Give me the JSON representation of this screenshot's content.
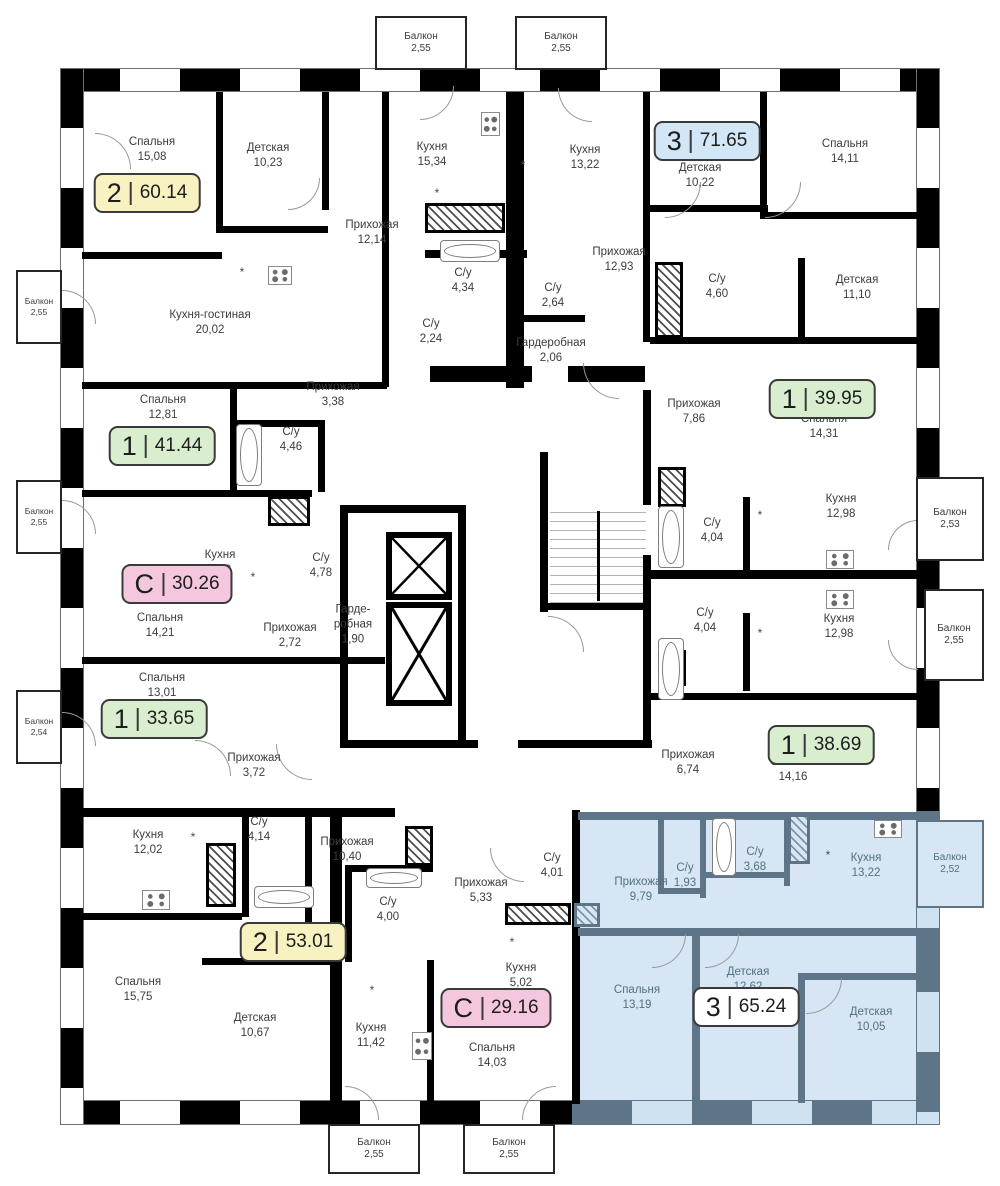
{
  "colors": {
    "wall": "#000000",
    "selected_fill": "#D6E6F4",
    "selected_wall": "#5E7487",
    "label_text": "#3c3c3c",
    "badge_yellow": "#F7F2C0",
    "badge_green": "#D9EECE",
    "badge_blue": "#D3E6F5",
    "badge_pink": "#F4C7DE",
    "badge_white": "#FFFFFF"
  },
  "balcony_label": "Балкон",
  "asterisk_glyph": "*",
  "badges": [
    {
      "num": "2",
      "area": "60.14",
      "color": "yellow",
      "x": 147,
      "y": 193
    },
    {
      "num": "3",
      "area": "71.65",
      "color": "blue",
      "x": 707,
      "y": 141
    },
    {
      "num": "1",
      "area": "41.44",
      "color": "green",
      "x": 162,
      "y": 446
    },
    {
      "num": "1",
      "area": "39.95",
      "color": "green",
      "x": 822,
      "y": 399
    },
    {
      "num": "С",
      "area": "30.26",
      "color": "pink",
      "x": 177,
      "y": 584
    },
    {
      "num": "1",
      "area": "33.65",
      "color": "green",
      "x": 154,
      "y": 719
    },
    {
      "num": "1",
      "area": "38.69",
      "color": "green",
      "x": 821,
      "y": 745
    },
    {
      "num": "2",
      "area": "53.01",
      "color": "yellow",
      "x": 293,
      "y": 942
    },
    {
      "num": "С",
      "area": "29.16",
      "color": "pink",
      "x": 496,
      "y": 1008
    },
    {
      "num": "3",
      "area": "65.24",
      "color": "white",
      "x": 746,
      "y": 1007,
      "selected": true
    }
  ],
  "rooms": [
    {
      "name": "Спальня",
      "area": "15,08",
      "x": 152,
      "y": 150
    },
    {
      "name": "Детская",
      "area": "10,23",
      "x": 268,
      "y": 156
    },
    {
      "name": "Кухня",
      "area": "15,34",
      "x": 432,
      "y": 155
    },
    {
      "name": "Кухня",
      "area": "13,22",
      "x": 585,
      "y": 158
    },
    {
      "name": "Детская",
      "area": "10,22",
      "x": 700,
      "y": 176
    },
    {
      "name": "Спальня",
      "area": "14,11",
      "x": 845,
      "y": 152
    },
    {
      "name": "Прихожая",
      "area": "12,14",
      "x": 372,
      "y": 233
    },
    {
      "name": "С/у",
      "area": "4,34",
      "x": 463,
      "y": 281
    },
    {
      "name": "С/у",
      "area": "2,64",
      "x": 553,
      "y": 296
    },
    {
      "name": "Прихожая",
      "area": "12,93",
      "x": 619,
      "y": 260
    },
    {
      "name": "С/у",
      "area": "4,60",
      "x": 717,
      "y": 287
    },
    {
      "name": "Детская",
      "area": "11,10",
      "x": 857,
      "y": 288
    },
    {
      "name": "Кухня-гостиная",
      "area": "20,02",
      "x": 210,
      "y": 323
    },
    {
      "name": "С/у",
      "area": "2,24",
      "x": 431,
      "y": 332
    },
    {
      "name": "Гардеробная",
      "area": "2,06",
      "x": 551,
      "y": 351
    },
    {
      "name": "Прихожая",
      "area": "3,38",
      "x": 333,
      "y": 395
    },
    {
      "name": "Спальня",
      "area": "12,81",
      "x": 163,
      "y": 408
    },
    {
      "name": "С/у",
      "area": "4,46",
      "x": 291,
      "y": 440
    },
    {
      "name": "Прихожая",
      "area": "7,86",
      "x": 694,
      "y": 412
    },
    {
      "name": "Спальня",
      "area": "14,31",
      "x": 824,
      "y": 427
    },
    {
      "name": "Кухня",
      "area": "5,88",
      "x": 220,
      "y": 563
    },
    {
      "name": "С/у",
      "area": "4,78",
      "x": 321,
      "y": 566
    },
    {
      "name": "Кухня",
      "area": "12,98",
      "x": 841,
      "y": 507
    },
    {
      "name": "С/у",
      "area": "4,04",
      "x": 712,
      "y": 531
    },
    {
      "name": "Спальня",
      "area": "14,21",
      "x": 160,
      "y": 626
    },
    {
      "name": "Прихожая",
      "area": "2,72",
      "x": 290,
      "y": 636
    },
    {
      "name": "Гарде- робная",
      "area": "1,90",
      "x": 353,
      "y": 625,
      "narrow": true
    },
    {
      "name": "С/у",
      "area": "4,04",
      "x": 705,
      "y": 621
    },
    {
      "name": "Кухня",
      "area": "12,98",
      "x": 839,
      "y": 627
    },
    {
      "name": "Спальня",
      "area": "13,01",
      "x": 162,
      "y": 686
    },
    {
      "name": "Прихожая",
      "area": "3,72",
      "x": 254,
      "y": 766
    },
    {
      "name": "Прихожая",
      "area": "6,74",
      "x": 688,
      "y": 763
    },
    {
      "name": "Спальня",
      "area": "14,16",
      "x": 793,
      "y": 770
    },
    {
      "name": "Кухня",
      "area": "12,02",
      "x": 148,
      "y": 843
    },
    {
      "name": "С/у",
      "area": "4,14",
      "x": 259,
      "y": 830
    },
    {
      "name": "Прихожая",
      "area": "10,40",
      "x": 347,
      "y": 850
    },
    {
      "name": "С/у",
      "area": "4,00",
      "x": 388,
      "y": 910
    },
    {
      "name": "Прихожая",
      "area": "5,33",
      "x": 481,
      "y": 891
    },
    {
      "name": "С/у",
      "area": "4,01",
      "x": 552,
      "y": 866
    },
    {
      "name": "Кухня",
      "area": "5,02",
      "x": 521,
      "y": 976
    },
    {
      "name": "Спальня",
      "area": "15,75",
      "x": 138,
      "y": 990
    },
    {
      "name": "Детская",
      "area": "10,67",
      "x": 255,
      "y": 1026
    },
    {
      "name": "Кухня",
      "area": "11,42",
      "x": 371,
      "y": 1036
    },
    {
      "name": "Спальня",
      "area": "14,03",
      "x": 492,
      "y": 1056
    },
    {
      "name": "Прихожая",
      "area": "9,79",
      "x": 641,
      "y": 890,
      "blue": true
    },
    {
      "name": "С/у",
      "area": "1,93",
      "x": 685,
      "y": 876,
      "blue": true
    },
    {
      "name": "С/у",
      "area": "3,68",
      "x": 755,
      "y": 860,
      "blue": true
    },
    {
      "name": "Кухня",
      "area": "13,22",
      "x": 866,
      "y": 866,
      "blue": true
    },
    {
      "name": "Спальня",
      "area": "13,19",
      "x": 637,
      "y": 998,
      "blue": true
    },
    {
      "name": "Детская",
      "area": "12,62",
      "x": 748,
      "y": 980,
      "blue": true
    },
    {
      "name": "Детская",
      "area": "10,05",
      "x": 871,
      "y": 1020,
      "blue": true
    }
  ],
  "balconies": [
    {
      "area": "2,55",
      "x": 375,
      "y": 16,
      "w": 92,
      "h": 54
    },
    {
      "area": "2,55",
      "x": 515,
      "y": 16,
      "w": 92,
      "h": 54
    },
    {
      "area": "2,55",
      "x": 16,
      "y": 270,
      "w": 46,
      "h": 74,
      "small": true
    },
    {
      "area": "2,55",
      "x": 16,
      "y": 480,
      "w": 46,
      "h": 74,
      "small": true
    },
    {
      "area": "2,54",
      "x": 16,
      "y": 690,
      "w": 46,
      "h": 74,
      "small": true
    },
    {
      "area": "2,53",
      "x": 916,
      "y": 477,
      "w": 68,
      "h": 84
    },
    {
      "area": "2,55",
      "x": 924,
      "y": 589,
      "w": 60,
      "h": 92
    },
    {
      "area": "2,52",
      "x": 916,
      "y": 820,
      "w": 68,
      "h": 88,
      "blue": true
    },
    {
      "area": "2,55",
      "x": 328,
      "y": 1124,
      "w": 92,
      "h": 50
    },
    {
      "area": "2,55",
      "x": 463,
      "y": 1124,
      "w": 92,
      "h": 50
    }
  ],
  "asterisks": [
    {
      "x": 242,
      "y": 272
    },
    {
      "x": 523,
      "y": 165
    },
    {
      "x": 437,
      "y": 193
    },
    {
      "x": 760,
      "y": 515
    },
    {
      "x": 760,
      "y": 633
    },
    {
      "x": 253,
      "y": 577
    },
    {
      "x": 193,
      "y": 837
    },
    {
      "x": 372,
      "y": 990
    },
    {
      "x": 512,
      "y": 942
    },
    {
      "x": 828,
      "y": 855
    }
  ]
}
